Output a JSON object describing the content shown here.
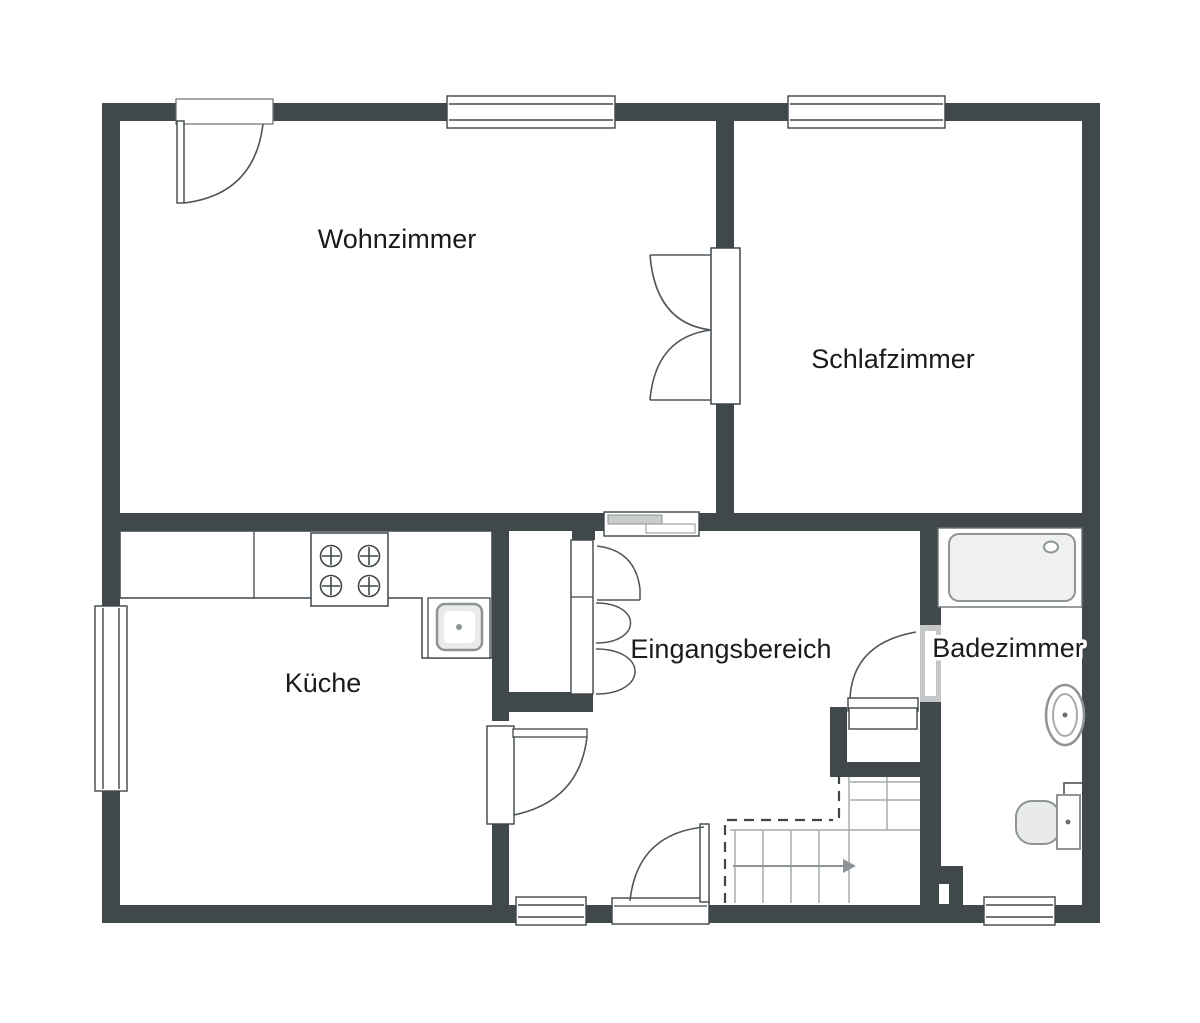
{
  "floorplan": {
    "rooms": [
      {
        "id": "wohnzimmer",
        "label": "Wohnzimmer"
      },
      {
        "id": "schlafzimmer",
        "label": "Schlafzimmer"
      },
      {
        "id": "kueche",
        "label": "Küche"
      },
      {
        "id": "eingangsbereich",
        "label": "Eingangsbereich"
      },
      {
        "id": "badezimmer",
        "label": "Badezimmer"
      }
    ],
    "fixtures": [
      "stove-4-burners",
      "kitchen-sink",
      "bathtub",
      "washbasin",
      "toilet",
      "staircase-with-direction-arrow",
      "entry-closet-double-door",
      "understair-closet",
      "sliding-door",
      "double-door-wohn-schlaf"
    ],
    "colors": {
      "wall": "#41484c",
      "outline": "#3f464a",
      "door_arc": "#4f565a",
      "fixture_border": "#8d9396",
      "fixture_fill": "#eceeee",
      "panel_gray": "#c9cbcc",
      "stair_line": "#a6acaf",
      "text": "#1b1b1b",
      "background": "#ffffff"
    }
  }
}
